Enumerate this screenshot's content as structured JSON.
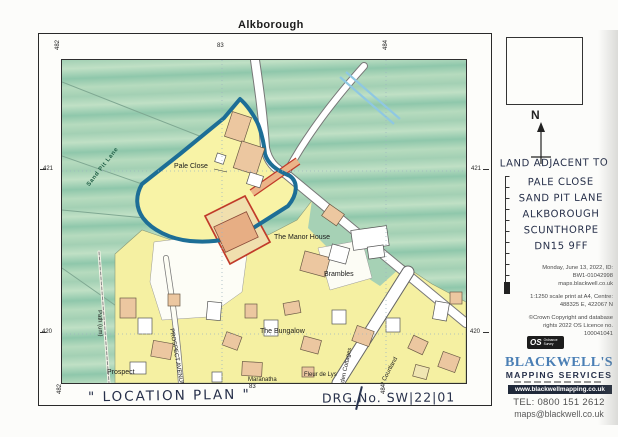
{
  "page": {
    "title": "Alkborough"
  },
  "map": {
    "grid": {
      "top_left": "482",
      "top_center": "83",
      "top_right": "484",
      "left_upper": "421",
      "left_lower": "420",
      "right_upper": "421",
      "right_lower": "420",
      "bottom_left": "482",
      "bottom_center": "83",
      "bottom_right": "484"
    },
    "places": {
      "pale_close": "Pale Close",
      "manor_house": "The Manor House",
      "brambles": "Brambles",
      "bungalow": "The Bungalow",
      "prospect": "Prospect",
      "prospect_avenue": "PROSPECT AVENUE",
      "path_um": "Path (um)",
      "maranatha": "Maranatha",
      "fleur_de_lys": "Fleur de Lys",
      "garden_cottages": "Garden Cottages",
      "courtland": "The Courtland",
      "sand_pit_lane": "Sand Pit Lane"
    }
  },
  "sidebar": {
    "north": "N",
    "address": [
      "LAND ADJACENT TO",
      "PALE CLOSE",
      "SAND PIT LANE",
      "ALKBOROUGH",
      "SCUNTHORPE",
      "DN15 9FF"
    ],
    "print_info": [
      "Monday, June 13, 2022, ID:",
      "BW1-01042998",
      "maps.blackwell.co.uk"
    ],
    "scale_info": [
      "1:1250 scale print at A4, Centre:",
      "488325 E, 422067 N"
    ],
    "copyright": [
      "©Crown Copyright and database",
      "rights 2022 OS Licence no.",
      "100041041"
    ],
    "os_logo": "OS",
    "os_logo_sub": "Ordnance Survey",
    "brand": {
      "name": "BLACKWELL'S",
      "subtitle": "MAPPING SERVICES",
      "website": "www.blackwellmapping.co.uk",
      "tel": "TEL: 0800 151 2612",
      "email": "maps@blackwell.co.uk"
    }
  },
  "footer": {
    "location_plan": "\" LOCATION PLAN \"",
    "drg_no": "DRG.No. SW|22|01"
  },
  "colors": {
    "boundary_blue": "#1d6e96",
    "boundary_red": "#c13b2a",
    "site_yellow": "#f8f3a6",
    "field_green": "#a3d0b4",
    "building_peach": "#ecc7a0",
    "brand_blue": "#4a7fb5",
    "ink": "#27304a"
  }
}
